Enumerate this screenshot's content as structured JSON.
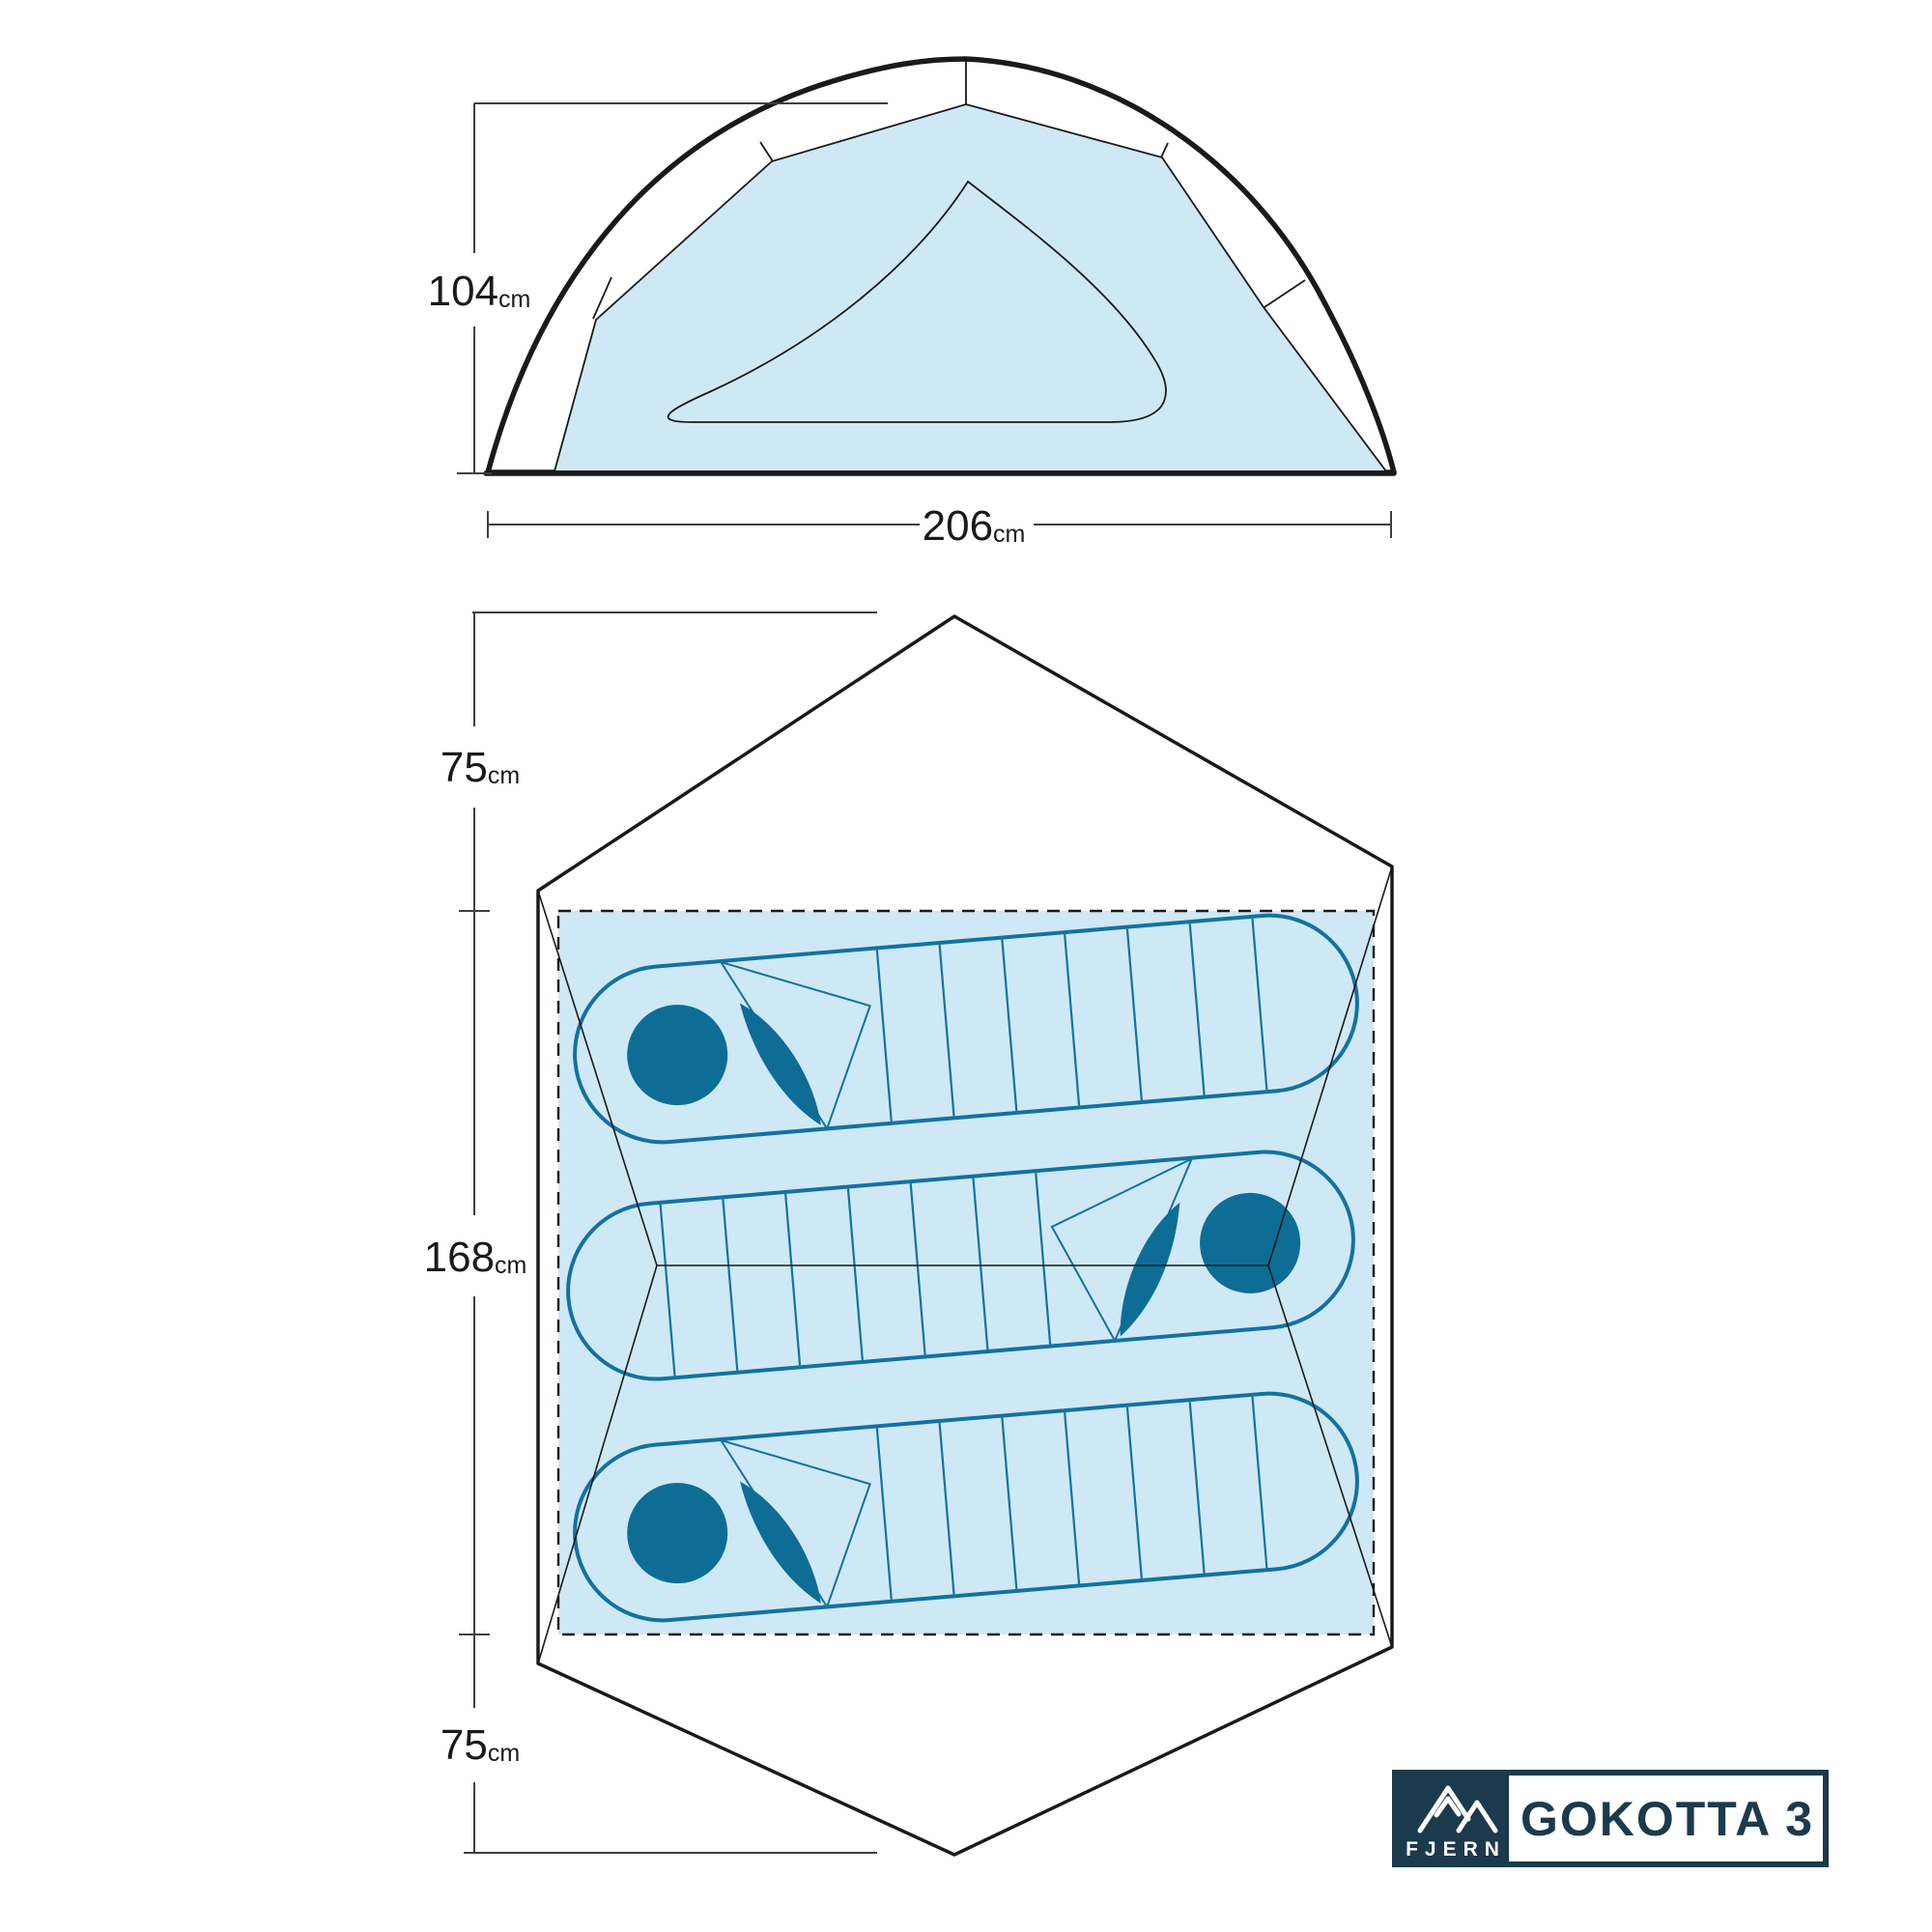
{
  "product": {
    "brand": "FJERN",
    "model": "GOKOTTA 3"
  },
  "side_view": {
    "height": {
      "value": "104",
      "unit": "cm"
    },
    "width": {
      "value": "206",
      "unit": "cm"
    }
  },
  "floor_plan": {
    "front_vestibule_depth": {
      "value": "75",
      "unit": "cm"
    },
    "inner_length": {
      "value": "168",
      "unit": "cm"
    },
    "rear_vestibule_depth": {
      "value": "75",
      "unit": "cm"
    },
    "sleeping_bag_count": "3"
  },
  "colors": {
    "panel_blue": "#cfe8f5",
    "teal_solid": "#0d6d96",
    "teal_stroke": "#1272a0",
    "navy": "#1b3a4b",
    "line_black": "#1a1a1a",
    "dim_gray": "#3f3f3f",
    "white": "#ffffff"
  }
}
